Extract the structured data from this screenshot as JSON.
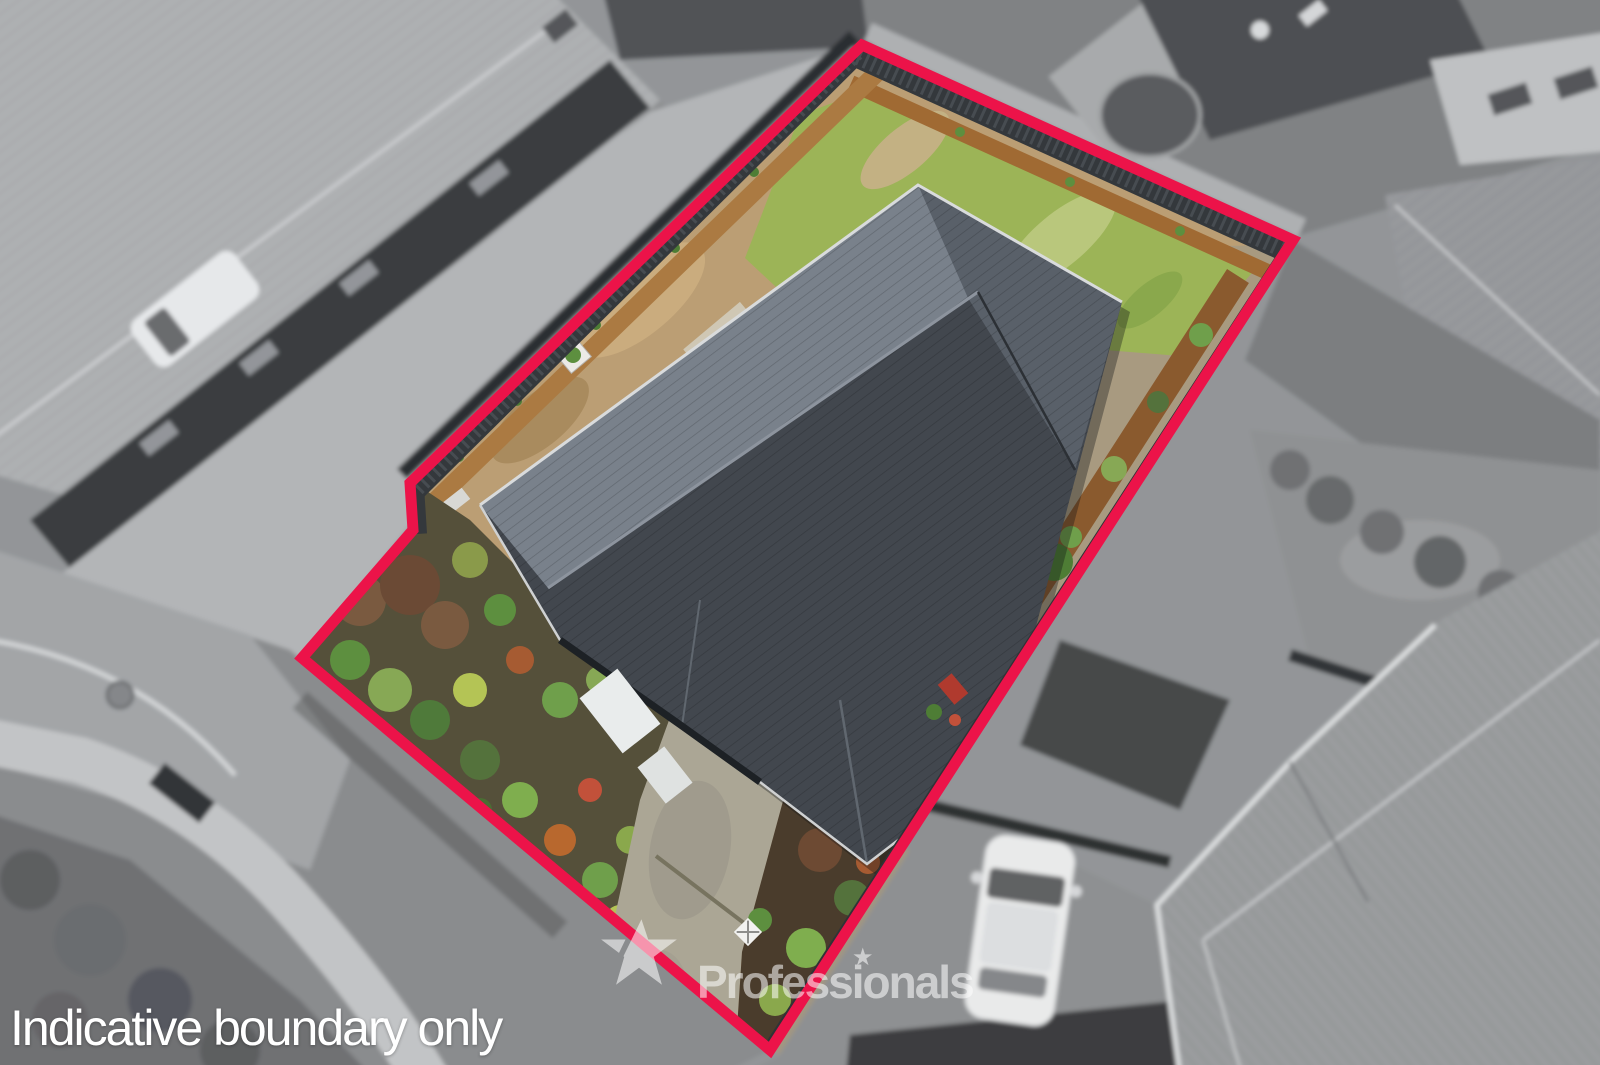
{
  "image": {
    "kind": "aerial drone photograph of a residential property",
    "subject": "single-storey house with dark tiled hip roof, lawn, gardens and driveway inside a marked section",
    "inside_boundary_effect": "full colour",
    "outside_boundary_effect": "grayscale, slightly blurred neighbourhood"
  },
  "overlay": {
    "disclaimer_text": "Indicative boundary only",
    "watermark_text": "Professionals",
    "watermark_star": "★",
    "boundary_color": "#ec1349",
    "text_color": "#ffffff",
    "watermark_opacity": "0.55"
  },
  "scene": {
    "colors": {
      "grass": "#9cb457",
      "dirt": "#bb9e74",
      "gravel": "#a89a80",
      "mulch_top": "#a06a33",
      "mulch_right": "#8a5a2e",
      "roof_dark": "#42474e",
      "roof_light": "#79818b",
      "roof_mid": "#596069",
      "fence": "#34383c",
      "driveway": "#aba695",
      "patio": "#b6b2a5",
      "garden_soil": "#55503a",
      "asphalt": "#8a8c8e",
      "sidewalk": "#c2c4c6",
      "neighbor_roof_tl": "#aeb0b2",
      "neighbor_roof_br": "#9a9c9e",
      "neighbor_lawn": "#8f9193",
      "car_white": "#e9eaea"
    }
  }
}
